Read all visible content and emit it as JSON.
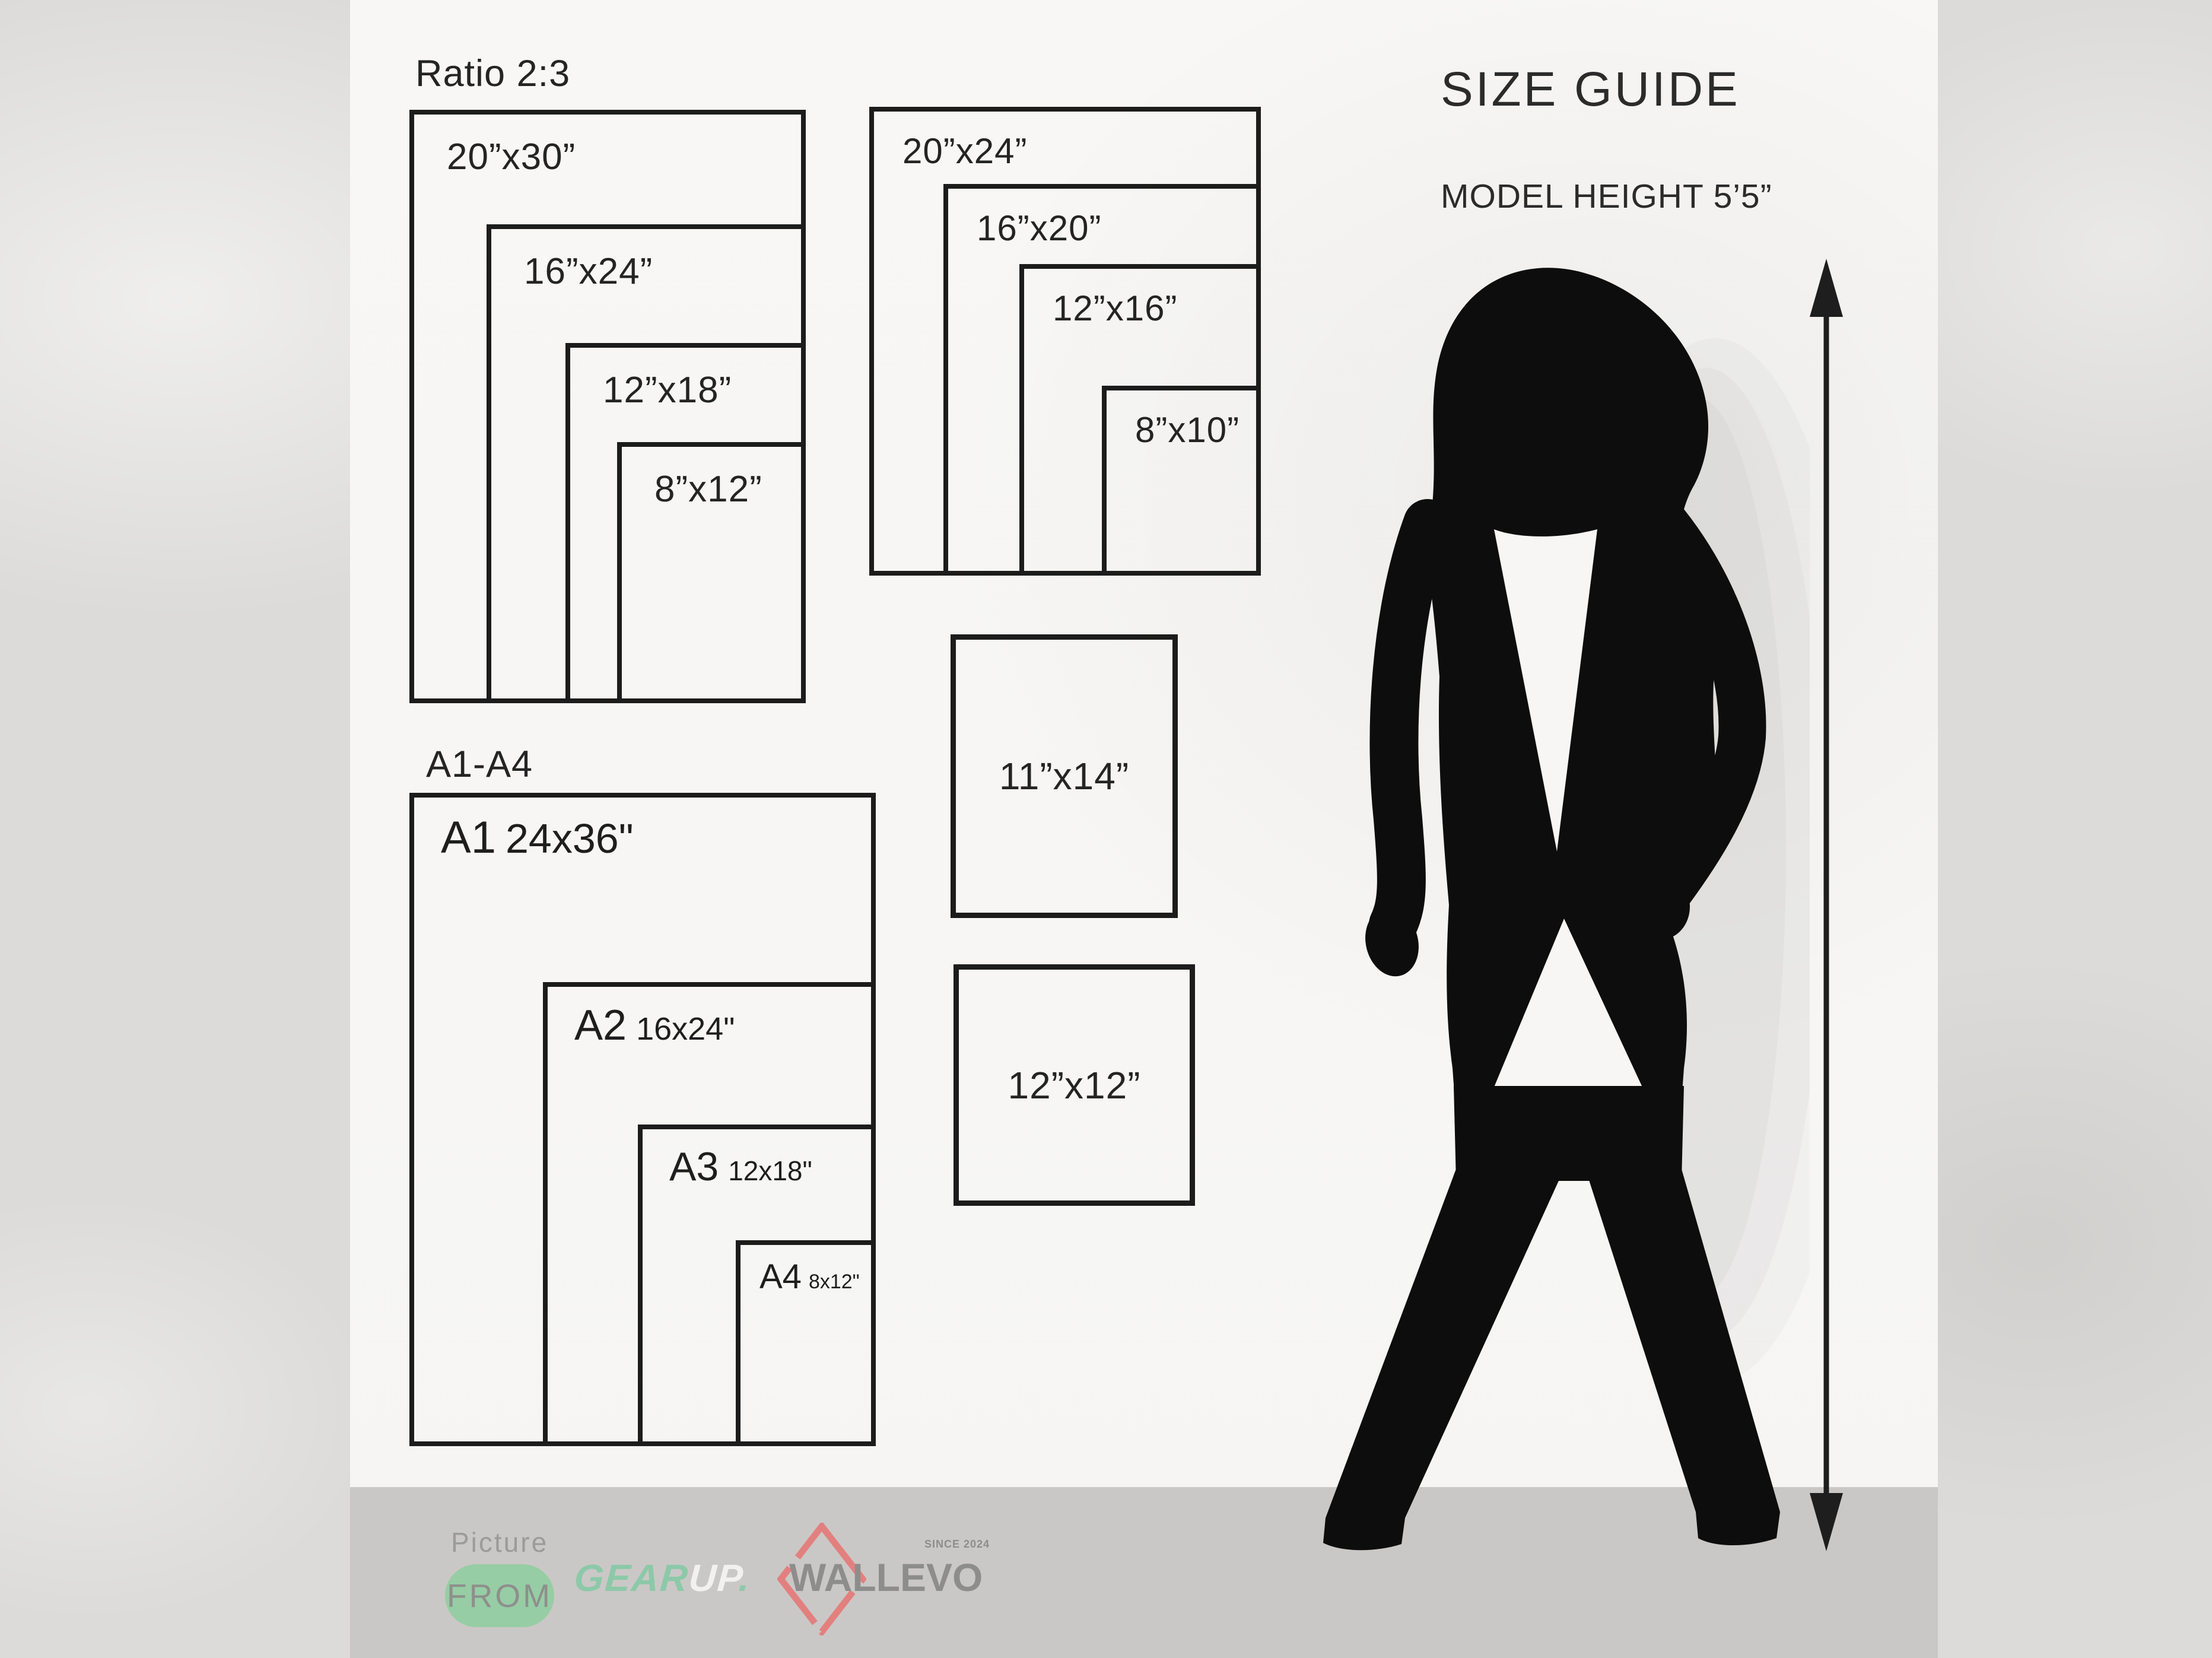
{
  "header": {
    "title": "SIZE GUIDE",
    "model_height": "MODEL HEIGHT 5’5”"
  },
  "ratio_group": {
    "label": "Ratio 2:3",
    "sizes": [
      "20”x30”",
      "16”x24”",
      "12”x18”",
      "8”x12”"
    ]
  },
  "standard_group": {
    "sizes": [
      "20”x24”",
      "16”x20”",
      "12”x16”",
      "8”x10”"
    ]
  },
  "a_series_group": {
    "label": "A1-A4",
    "items": [
      {
        "code": "A1",
        "size": "24x36\""
      },
      {
        "code": "A2",
        "size": "16x24\""
      },
      {
        "code": "A3",
        "size": "12x18\""
      },
      {
        "code": "A4",
        "size": "8x12\""
      }
    ]
  },
  "single_boxes": {
    "box_11x14": "11”x14”",
    "box_12x12": "12”x12”"
  },
  "footer": {
    "picture": "Picture",
    "from": "FROM",
    "gearup_gear": "GEAR",
    "gearup_up": "UP",
    "gearup_dot": ".",
    "wallevo": "WALLEVO",
    "wallevo_since": "SINCE 2024"
  },
  "colors": {
    "panel": "#f7f6f4",
    "background": "#dcdbd9",
    "band": "#cac8c6",
    "line": "#1c1c1c",
    "green_pill": "#97cda4",
    "gear_green": "#8cc9a8",
    "logo_gray": "#8d8d8c",
    "diamond_red": "#e2807f",
    "silhouette_black": "#0d0d0d"
  }
}
